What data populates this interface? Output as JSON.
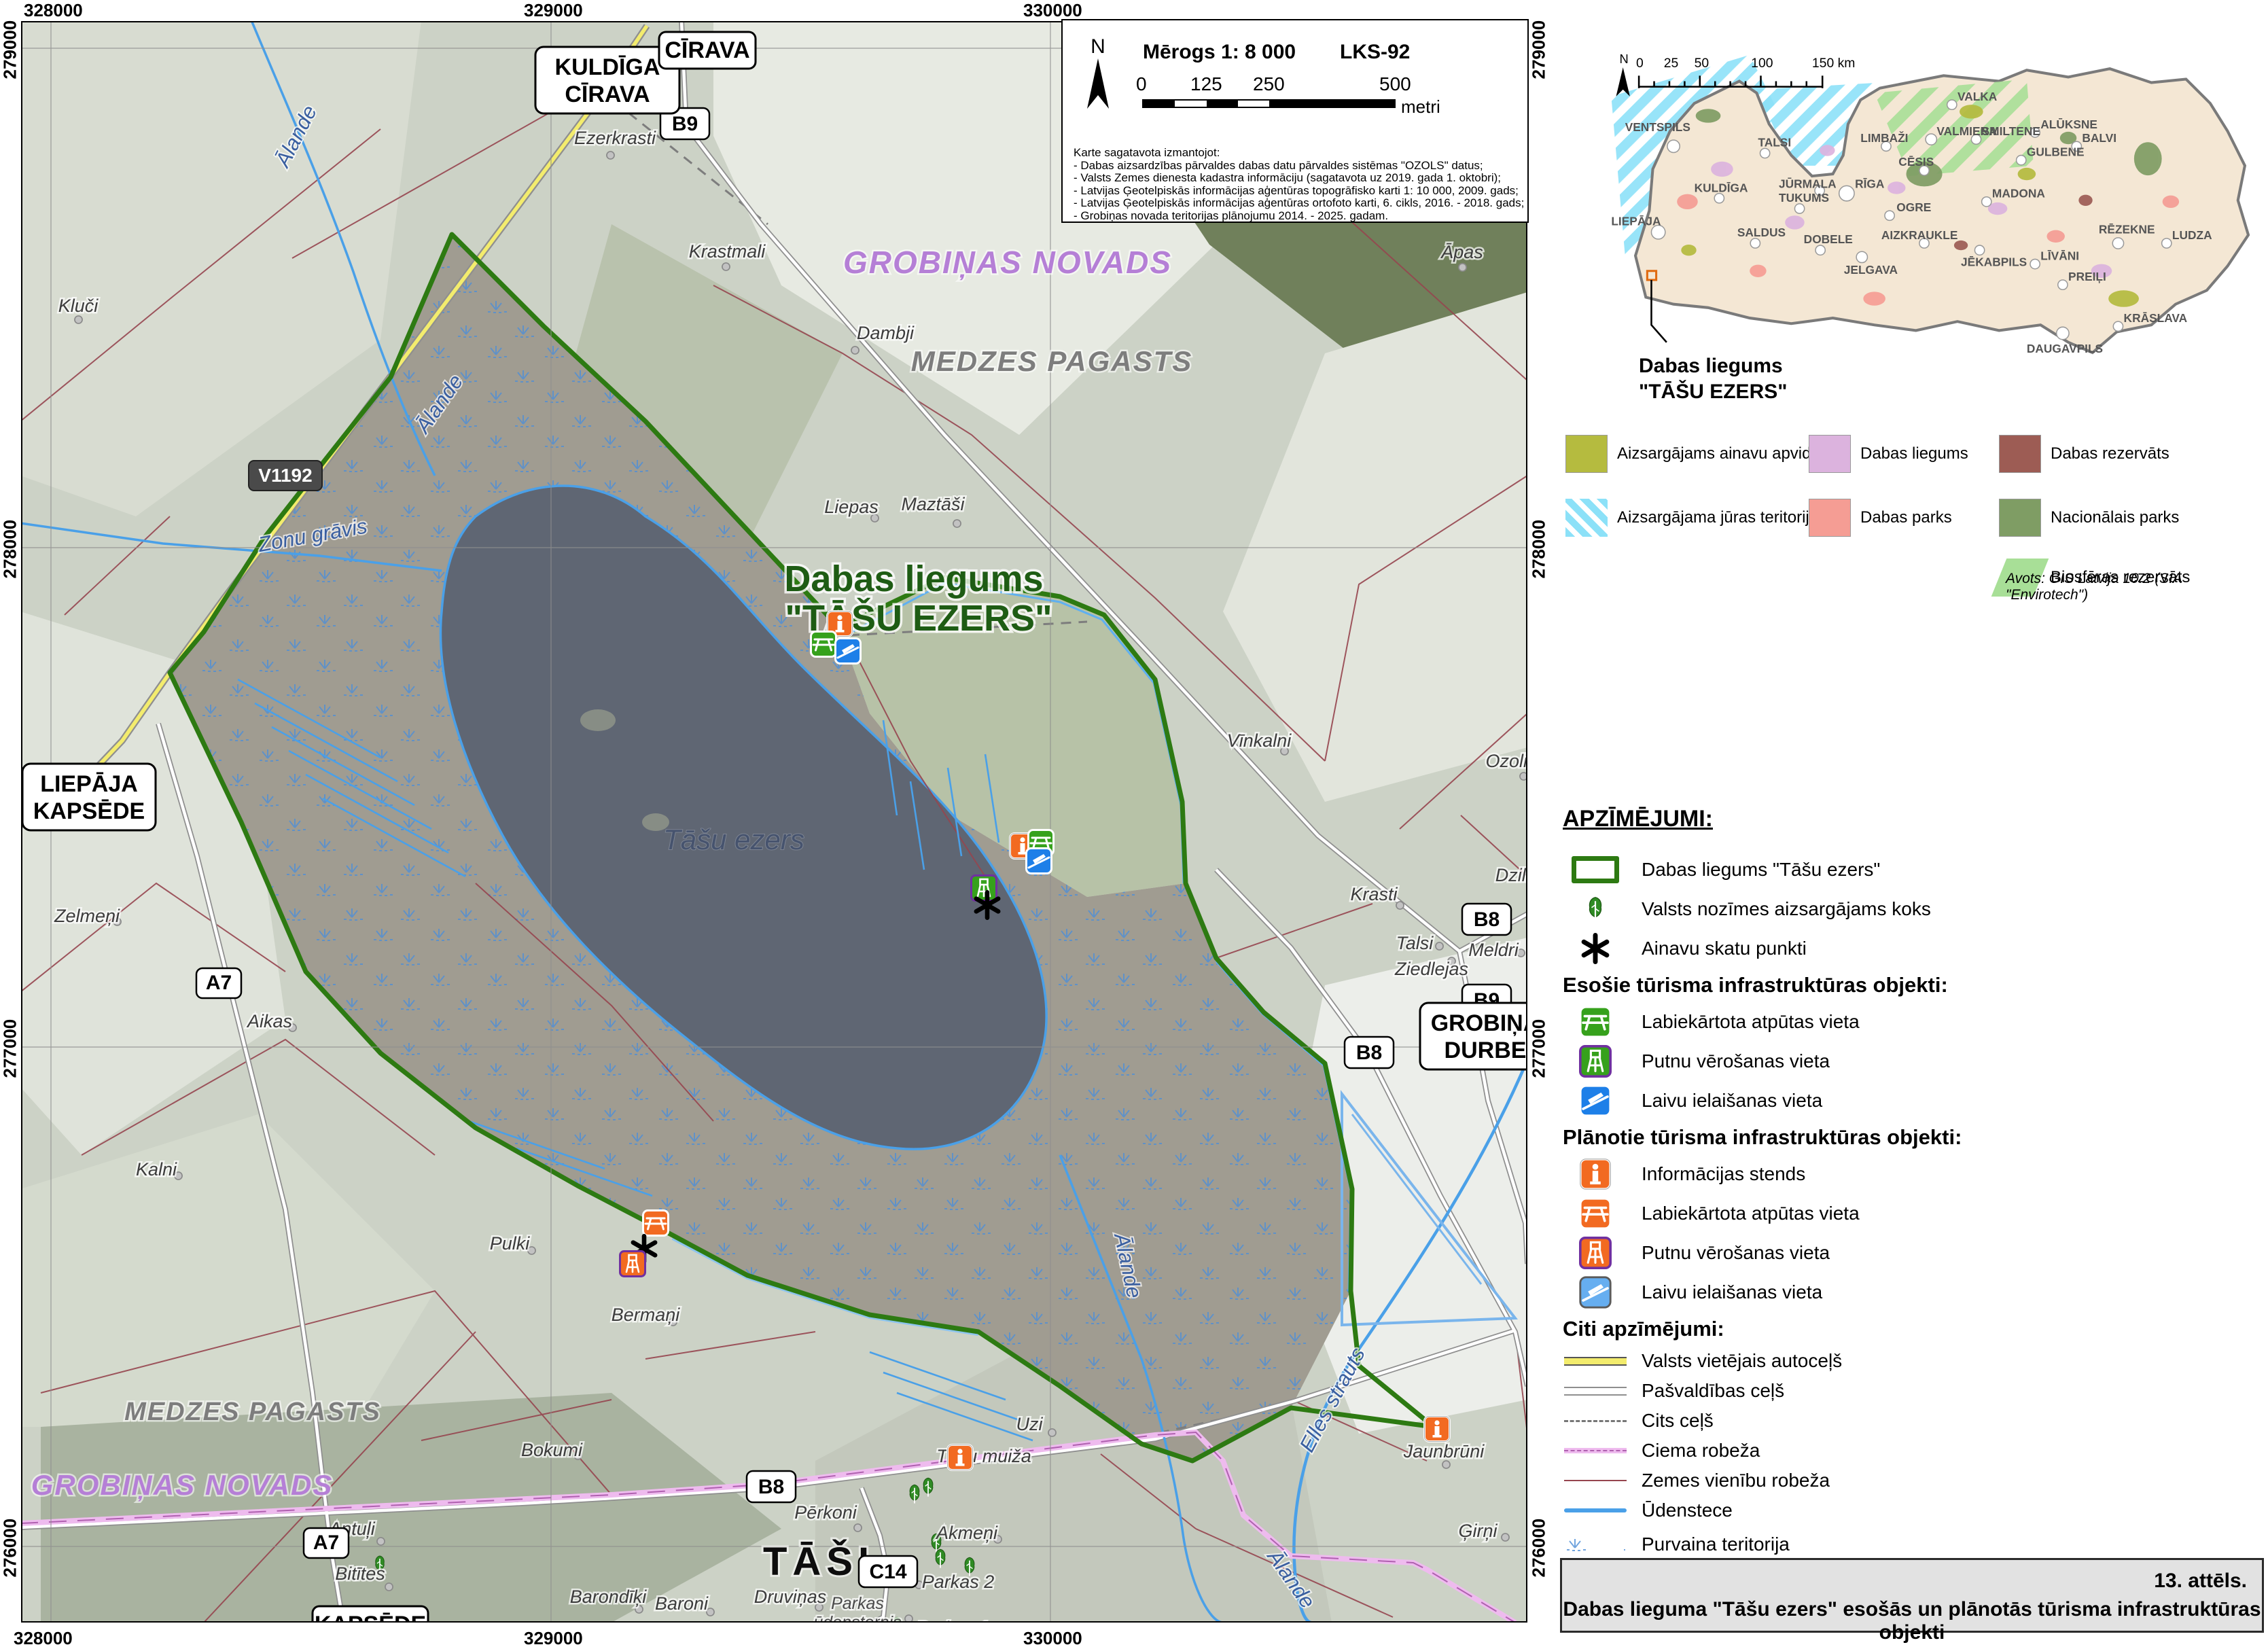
{
  "axis": {
    "top": [
      "328000",
      "329000",
      "330000"
    ],
    "bottom": [
      "328000",
      "329000",
      "330000"
    ],
    "left": [
      "279000",
      "278000",
      "277000",
      "276000"
    ],
    "right": [
      "279000",
      "278000",
      "277000",
      "276000"
    ]
  },
  "scalebox": {
    "north": "N",
    "title": "Mērogs 1: 8 000",
    "crs": "LKS-92",
    "ticks": [
      "0",
      "125",
      "250",
      "500"
    ],
    "unit": "metri",
    "sources": {
      "intro": "Karte sagatavota izmantojot:",
      "l1": "- Dabas aizsardzības pārvaldes dabas datu pārvaldes sistēmas \"OZOLS\" datus;",
      "l2": "- Valsts Zemes dienesta kadastra informāciju (sagatavota uz 2019. gada 1. oktobri);",
      "l3": "- Latvijas Ģeotelpiskās informācijas aģentūras topogrāfisko karti 1: 10 000, 2009. gads;",
      "l4": "- Latvijas Ģeotelpiskās informācijas aģentūras ortofoto karti, 6. cikls, 2016. - 2018. gads;",
      "l5": "- Grobiņas novada teritorijas plānojumu 2014. - 2025. gadam."
    }
  },
  "signs": {
    "kuldiga": "KULDĪGA",
    "cirava": "CĪRAVA",
    "liepaja": "LIEPĀJA",
    "kapsede": "KAPSĒDE",
    "grobina": "GROBIŅA",
    "durbe": "DURBE",
    "tasi": "TĀŠI"
  },
  "badges": {
    "v1192": "V1192",
    "b9": "B9",
    "b8": "B8",
    "a7": "A7",
    "c14": "C14"
  },
  "map_labels": {
    "title1": "Dabas liegums",
    "title2": "\"TĀŠU EZERS\"",
    "lake": "Tāšu ezers",
    "novads": "GROBIŅAS NOVADS",
    "pagasts": "MEDZES PAGASTS",
    "alande": "Ālande",
    "zonu": "Zonu grāvis",
    "elles": "Elles strauts",
    "parkas_u1": "Parkas",
    "parkas_u2": "ūdenstornis",
    "tasu_muiza": "Tāšu muiža",
    "places": [
      "Ezerkrasti",
      "Krastmali",
      "Kluči",
      "Dambji",
      "Liepas",
      "Maztāši",
      "Āpas",
      "Vīnkalni",
      "Ozoliejas",
      "Krasti",
      "Dzilnas",
      "Talsi",
      "Ziedlejas",
      "Meldri",
      "Zelmeņi",
      "Aikas",
      "Kalni",
      "Pulki",
      "Bermaņi",
      "Bokumi",
      "Antuļi",
      "Bitītes",
      "Barondīķi",
      "Baroni",
      "Vārpas",
      "Druviņas",
      "Pērkoni",
      "Akmeņi",
      "Uzi",
      "Jaunbrūni",
      "Ģirņi",
      "Parkas 2",
      "Parkas 1"
    ]
  },
  "inset": {
    "north": "N",
    "scale_ticks": [
      "0",
      "25",
      "50",
      "100",
      "150 km"
    ],
    "callout1": "Dabas liegums",
    "callout2": "\"TĀŠU EZERS\"",
    "source": "Avots: GIS Latvija 10.2 (SIA \"Envirotech\")",
    "legend": [
      {
        "label": "Aizsargājams ainavu apvidus",
        "color": "#b5bb3f"
      },
      {
        "label": "Aizsargājama jūras teritorija",
        "color": "#8ce1f8"
      },
      {
        "label": "Dabas liegums",
        "color": "#dcb3de"
      },
      {
        "label": "Dabas parks",
        "color": "#f59d94"
      },
      {
        "label": "Dabas rezervāts",
        "color": "#9d5c54"
      },
      {
        "label": "Nacionālais parks",
        "color": "#7f9d64"
      },
      {
        "label": "Biosfēras rezervāts",
        "color": "#a8df97"
      }
    ],
    "cities": [
      "VENTSPILS",
      "TALSI",
      "KULDĪGA",
      "LIEPĀJA",
      "SALDUS",
      "DOBELE",
      "JELGAVA",
      "TUKUMS",
      "JŪRMALA",
      "RĪGA",
      "OGRE",
      "LIMBAŽI",
      "VALMIERA",
      "VALKA",
      "SMILTENE",
      "ALŪKSNE",
      "GULBENE",
      "BALVI",
      "CĒSIS",
      "MADONA",
      "AIZKRAUKLE",
      "JĒKABPILS",
      "LĪVĀNI",
      "PREIĻI",
      "RĒZEKNE",
      "LUDZA",
      "DAUGAVPILS",
      "KRĀSLAVA"
    ]
  },
  "legend": {
    "title": "APZĪMĒJUMI:",
    "boundary": "Dabas liegums \"Tāšu ezers\"",
    "tree": "Valsts nozīmes aizsargājams koks",
    "viewpoint": "Ainavu skatu punkti",
    "existing_header": "Esošie tūrisma infrastruktūras objekti:",
    "ex_picnic": "Labiekārtota atpūtas vieta",
    "ex_tower": "Putnu vērošanas vieta",
    "ex_boat": "Laivu ielaišanas vieta",
    "planned_header": "Plānotie tūrisma infrastruktūras objekti:",
    "pl_info": "Informācijas stends",
    "pl_picnic": "Labiekārtota atpūtas vieta",
    "pl_tower": "Putnu vērošanas vieta",
    "pl_boat": "Laivu ielaišanas vieta",
    "other_header": "Citi apzīmējumi:",
    "road_state": "Valsts vietējais autoceļš",
    "road_municipal": "Pašvaldības ceļš",
    "road_other": "Cits ceļš",
    "village_border": "Ciema robeža",
    "parcel_border": "Zemes vienību robeža",
    "watercourse": "Ūdenstece",
    "marsh": "Purvaina teritorija",
    "homestead": "Viensēta"
  },
  "caption": {
    "line1": "13. attēls.",
    "line2": "Dabas lieguma \"Tāšu ezers\" esošās un plānotās tūrisma infrastruktūras objekti"
  },
  "colors": {
    "reserve_boundary_green": "#2d7a12",
    "planned_orange": "#f26a21",
    "existing_green": "#36a11c",
    "water_blue": "#4aa0e8",
    "village_pink": "#eebbee",
    "parcel_red": "#96454f"
  }
}
